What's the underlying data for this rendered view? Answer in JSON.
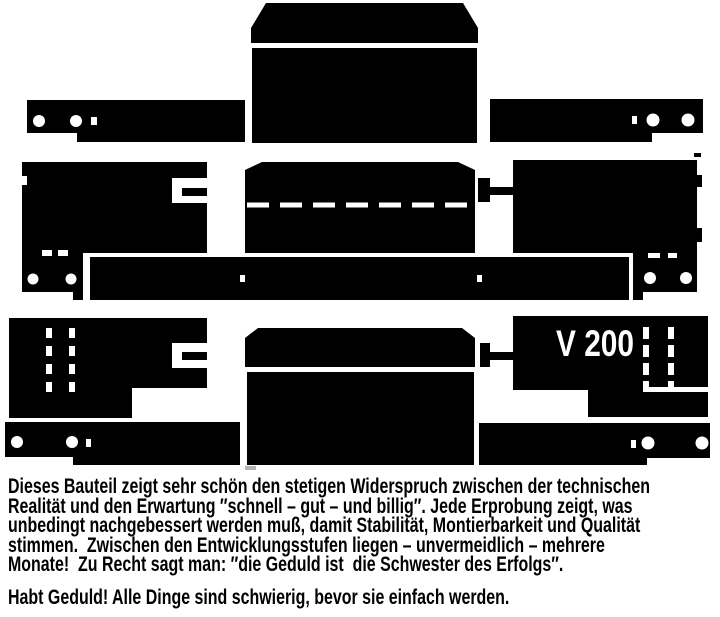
{
  "figure": {
    "v200_label": "V 200",
    "colors": {
      "ink": "#000000",
      "paper": "#ffffff",
      "scan_artifact_gray": "#b3b3b3"
    }
  },
  "caption": {
    "lines": [
      "Dieses Bauteil zeigt sehr schön den stetigen Widerspruch zwischen der technischen",
      "Realität und den Erwartung ″schnell – gut – und billig″. Jede Erprobung zeigt, was",
      "unbedingt nachgebessert werden muß, damit Stabilität, Montierbarkeit und Qualität",
      "stimmen.  Zwischen den Entwicklungsstufen liegen – unvermeidlich – mehrere",
      "Monate!  Zu Recht sagt man: ″die Geduld ist  die Schwester des Erfolgs″.",
      "Habt Geduld! Alle Dinge sind schwierig, bevor sie einfach werden."
    ]
  }
}
